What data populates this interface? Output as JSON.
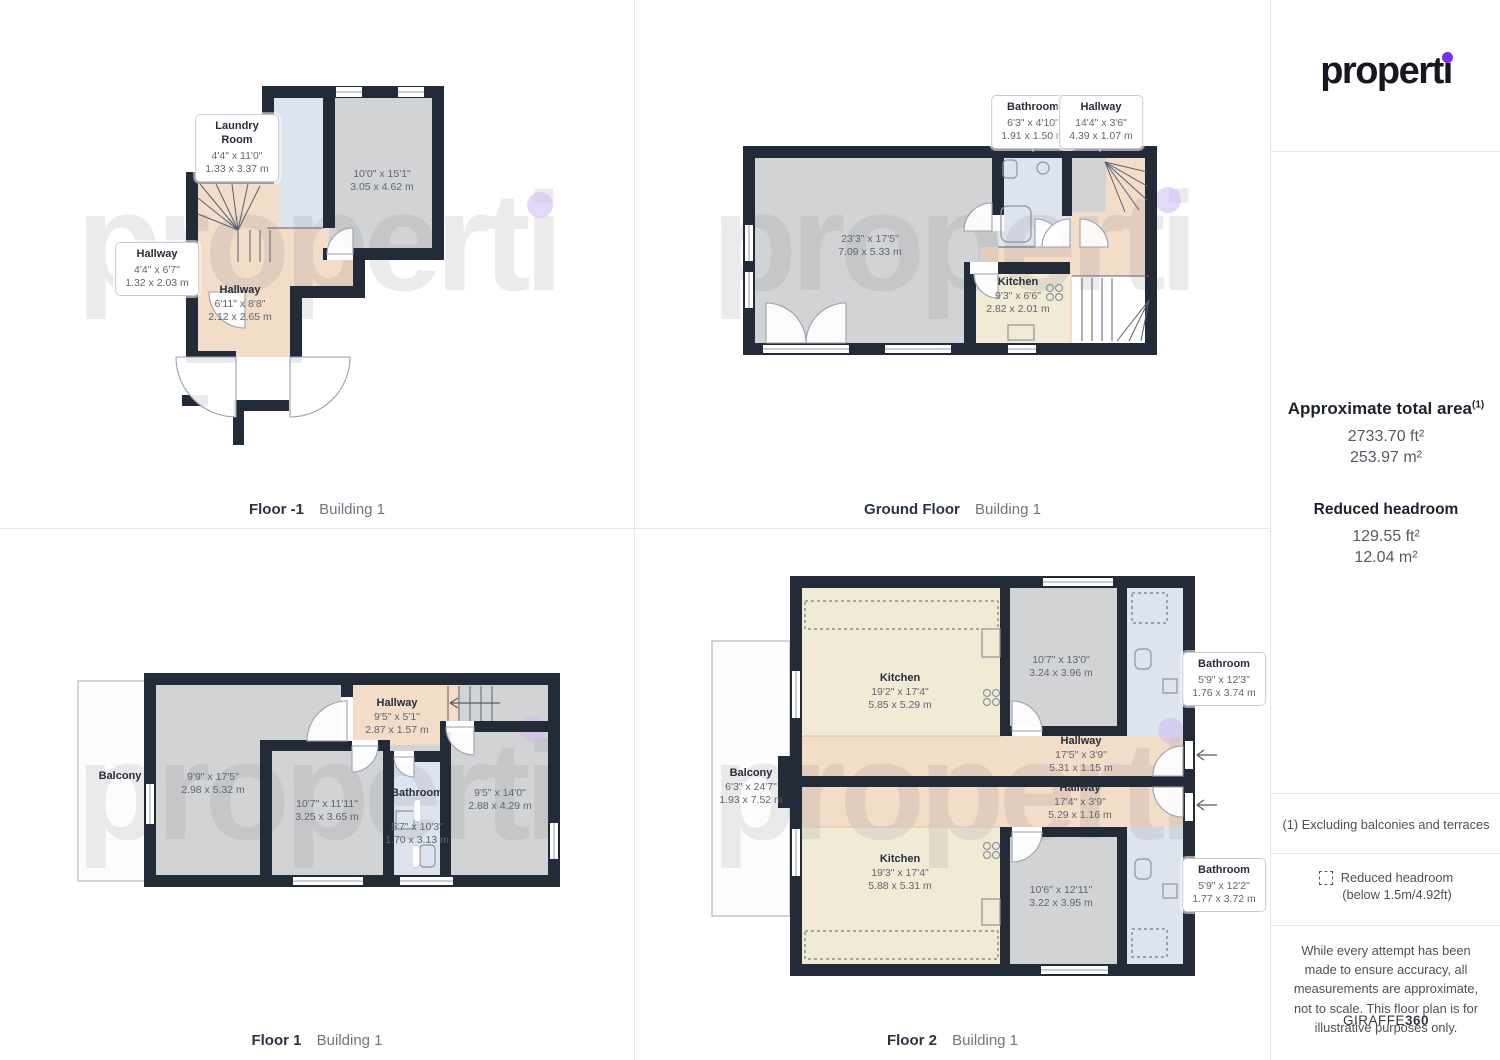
{
  "colors": {
    "wall": "#232b38",
    "room_gray": "#d2d3d4",
    "hallway_peach": "#f3dcc8",
    "bathroom_blue": "#dee4ee",
    "kitchen_cream": "#f1ebd6",
    "accent_purple": "#7a2ff0",
    "watermark_gray": "#80808a",
    "watermark_dot_lavender": "#cdb9f2",
    "caption_dark": "#2b3442",
    "caption_muted": "#6e7680"
  },
  "brand": {
    "logo_text": "properti",
    "watermark": "properti"
  },
  "sidebar": {
    "total_area": {
      "title": "Approximate total area",
      "superscript": "(1)",
      "value_ft": "2733.70 ft²",
      "value_m": "253.97 m²"
    },
    "reduced_headroom": {
      "title": "Reduced headroom",
      "value_ft": "129.55 ft²",
      "value_m": "12.04 m²"
    },
    "footnote": "(1) Excluding balconies and terraces",
    "headroom_legend_line1": "Reduced headroom",
    "headroom_legend_line2": "(below 1.5m/4.92ft)",
    "disclaimer": "While every attempt has been made to ensure accuracy, all measurements are approximate, not to scale. This floor plan is for illustrative purposes only.",
    "brand_footer_regular": "GIRAFFE",
    "brand_footer_bold": "360"
  },
  "plans": {
    "floor_minus_1": {
      "caption": "Floor -1",
      "building": "Building 1",
      "labels": {
        "laundry": {
          "name": "Laundry\nRoom",
          "ft": "4'4\" x 11'0\"",
          "m": "1.33 x 3.37 m"
        },
        "storage_room": {
          "ft": "10'0\" x 15'1\"",
          "m": "3.05 x 4.62 m"
        },
        "hallway_small": {
          "name": "Hallway",
          "ft": "4'4\" x 6'7\"",
          "m": "1.32 x 2.03 m"
        },
        "hallway": {
          "name": "Hallway",
          "ft": "6'11\" x 8'8\"",
          "m": "2.12 x 2.65 m"
        }
      }
    },
    "ground_floor": {
      "caption": "Ground Floor",
      "building": "Building 1",
      "labels": {
        "bathroom": {
          "name": "Bathroom",
          "ft": "6'3\" x 4'10\"",
          "m": "1.91 x 1.50 m"
        },
        "hallway": {
          "name": "Hallway",
          "ft": "14'4\" x 3'6\"",
          "m": "4.39 x 1.07 m"
        },
        "living_room": {
          "ft": "23'3\" x 17'5\"",
          "m": "7.09 x 5.33 m"
        },
        "kitchen": {
          "name": "Kitchen",
          "ft": "9'3\" x 6'6\"",
          "m": "2.82 x 2.01 m"
        }
      }
    },
    "floor_1": {
      "caption": "Floor 1",
      "building": "Building 1",
      "labels": {
        "balcony": {
          "name": "Balcony"
        },
        "room_left": {
          "ft": "9'9\" x 17'5\"",
          "m": "2.98 x 5.32 m"
        },
        "hallway": {
          "name": "Hallway",
          "ft": "9'5\" x 5'1\"",
          "m": "2.87 x 1.57 m"
        },
        "room_middle": {
          "ft": "10'7\" x 11'11\"",
          "m": "3.25 x 3.65 m"
        },
        "bathroom": {
          "name": "Bathroom",
          "ft": "5'7\" x 10'3\"",
          "m": "1.70 x 3.13 m"
        },
        "room_right": {
          "ft": "9'5\" x 14'0\"",
          "m": "2.88 x 4.29 m"
        }
      }
    },
    "floor_2": {
      "caption": "Floor 2",
      "building": "Building 1",
      "labels": {
        "kitchen_top": {
          "name": "Kitchen",
          "ft": "19'2\" x 17'4\"",
          "m": "5.85 x 5.29 m"
        },
        "room_top": {
          "ft": "10'7\" x 13'0\"",
          "m": "3.24 x 3.96 m"
        },
        "bathroom_top": {
          "name": "Bathroom",
          "ft": "5'9\" x 12'3\"",
          "m": "1.76 x 3.74 m"
        },
        "hallway_top": {
          "name": "Hallway",
          "ft": "17'5\" x 3'9\"",
          "m": "5.31 x 1.15 m"
        },
        "hallway_bottom": {
          "name": "Hallway",
          "ft": "17'4\" x 3'9\"",
          "m": "5.29 x 1.16 m"
        },
        "balcony": {
          "name": "Balcony",
          "ft": "6'3\" x 24'7\"",
          "m": "1.93 x 7.52 m"
        },
        "kitchen_bottom": {
          "name": "Kitchen",
          "ft": "19'3\" x 17'4\"",
          "m": "5.88 x 5.31 m"
        },
        "room_bottom": {
          "ft": "10'6\" x 12'11\"",
          "m": "3.22 x 3.95 m"
        },
        "bathroom_bottom": {
          "name": "Bathroom",
          "ft": "5'9\" x 12'2\"",
          "m": "1.77 x 3.72 m"
        }
      }
    }
  }
}
